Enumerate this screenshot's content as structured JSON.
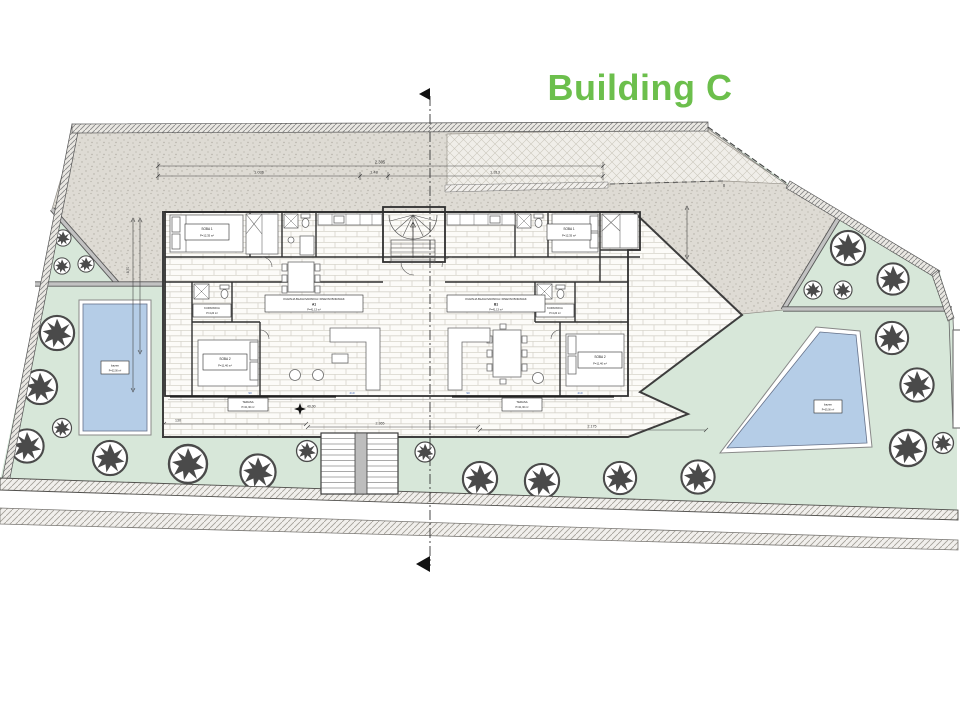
{
  "title": "Building C",
  "colors": {
    "accent": "#6cbf4c",
    "garden": "#d7e7d9",
    "pool": "#b5cde7",
    "paving": "#dedbd4"
  },
  "pools": {
    "left": {
      "name": "bazen",
      "area": "P=32,00 m²"
    },
    "right": {
      "name": "bazen",
      "area": "P=35,00 m²"
    }
  },
  "dims": {
    "top_total": "2.305",
    "top_a": "1.036",
    "top_b": "1.48",
    "top_c": "1.313",
    "left_v": "8,70",
    "bottom_a": "130",
    "bottom_b": "2.365",
    "bottom_c": "2.175",
    "spot": "40,00"
  },
  "units": {
    "a": {
      "no": "A1",
      "living": "KUHINJA BLAGOVAONICA I DNEVNI BORAVAK",
      "living_area": "P=41,13 m²",
      "bed1": "SOBA 1",
      "bed1_area": "P=12,35 m²",
      "bed2": "SOBA 2",
      "bed2_area": "P=11,40 m²",
      "bath": "KUPAONICA",
      "bath_area": "P=4,20 m²",
      "terrace": "TERASA",
      "terrace_area": "P=21,30 m²"
    },
    "b": {
      "no": "B1",
      "living": "KUHINJA BLAGOVAONICA I DNEVNI BORAVAK",
      "living_area": "P=41,13 m²",
      "bed1": "SOBA 1",
      "bed1_area": "P=12,35 m²",
      "bed2": "SOBA 2",
      "bed2_area": "P=11,40 m²",
      "bath": "KUPAONICA",
      "bath_area": "P=4,20 m²",
      "terrace": "TERASA",
      "terrace_area": "P=21,30 m²"
    }
  },
  "tags": [
    "90",
    "210",
    "90",
    "210"
  ]
}
